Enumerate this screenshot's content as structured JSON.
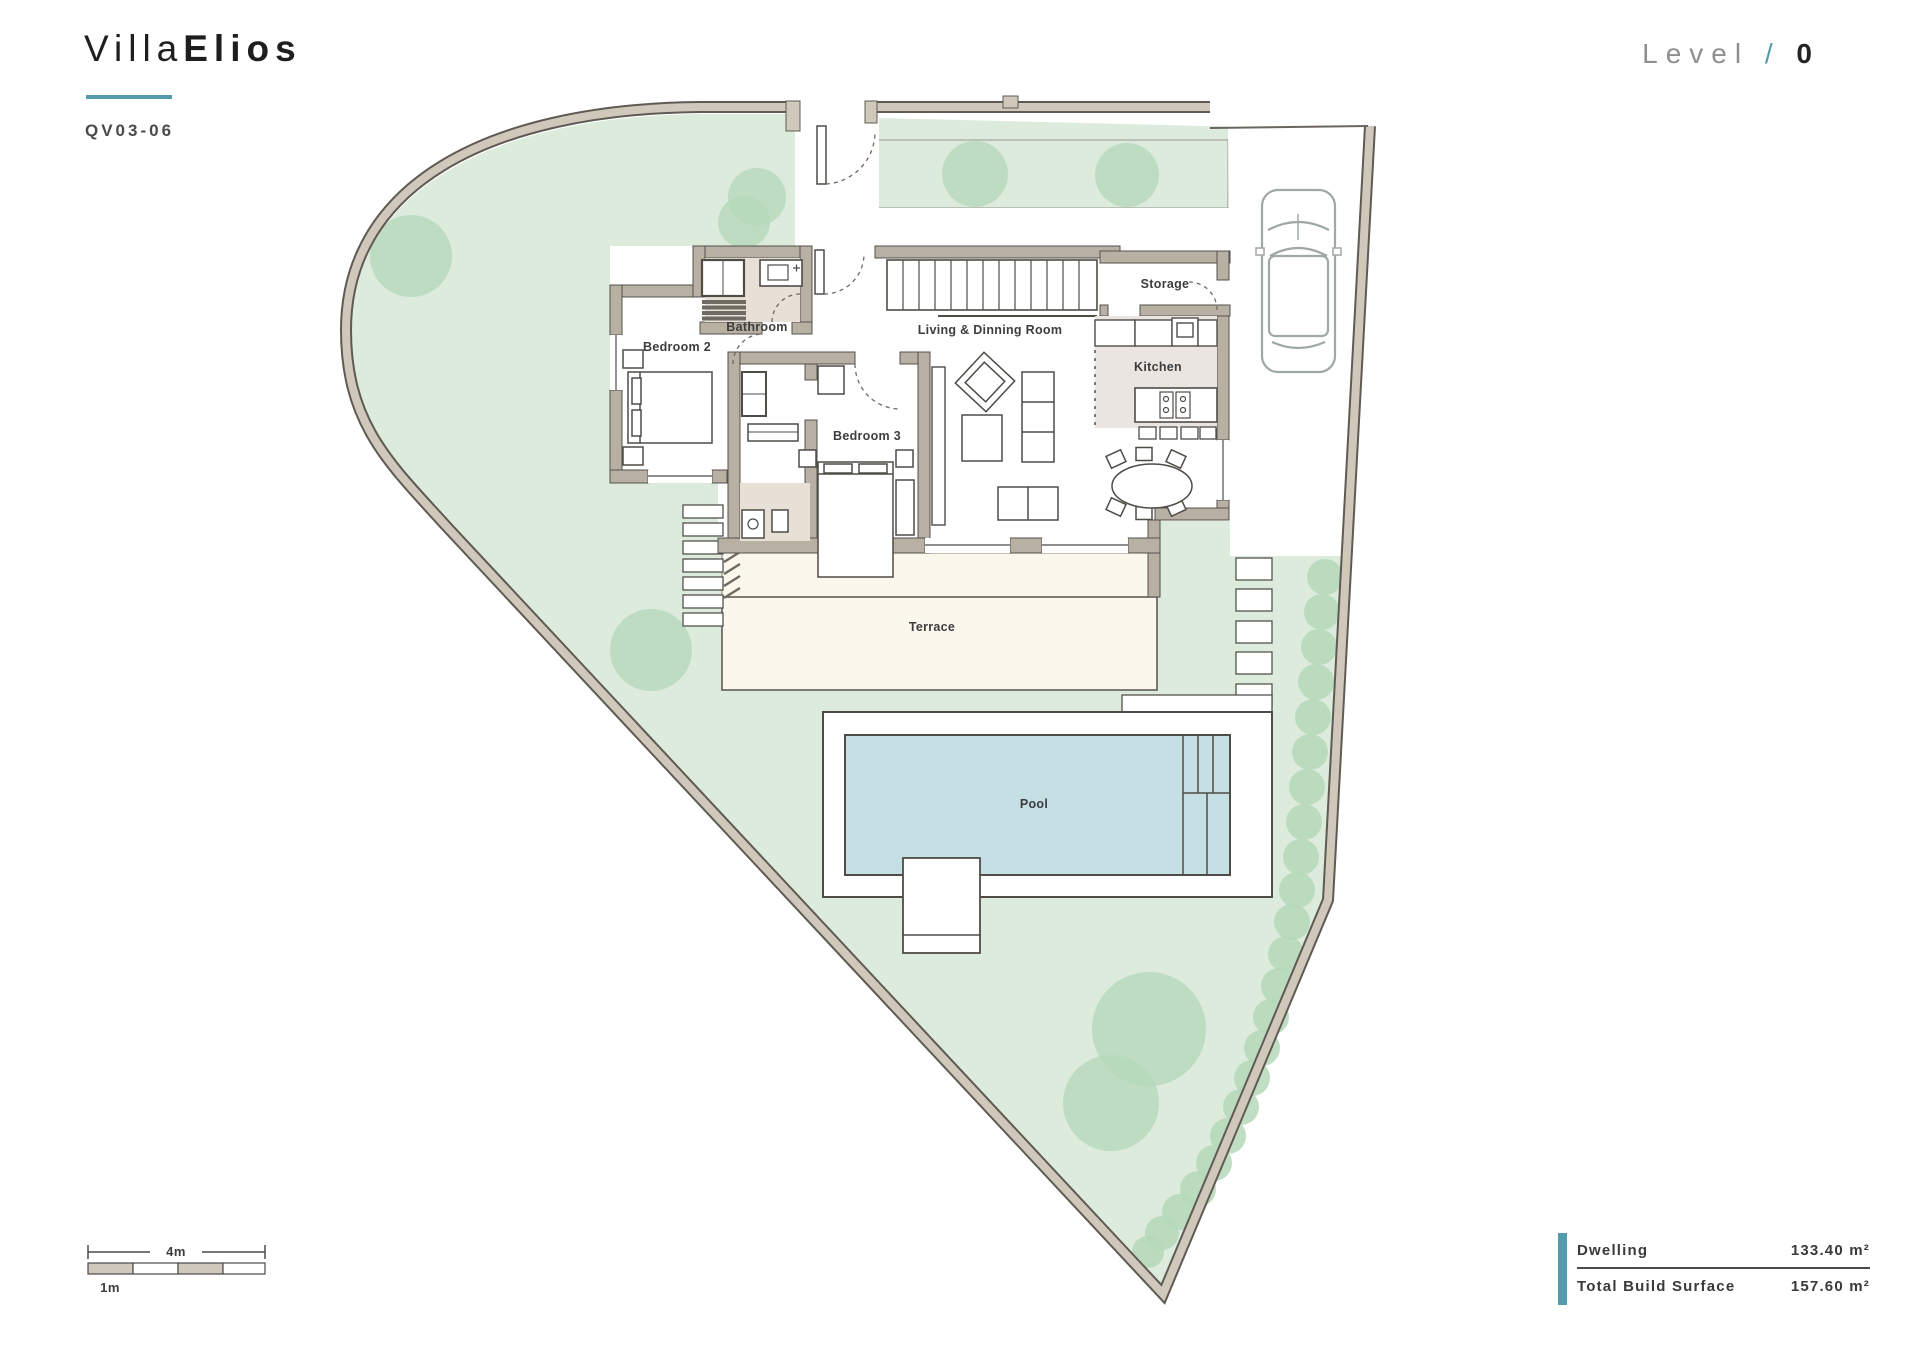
{
  "header": {
    "title_light": "Villa",
    "title_bold": "Elios",
    "unit_code": "QV03-06",
    "level_label": "Level",
    "level_sep": "/",
    "level_value": "0"
  },
  "plan": {
    "labels": {
      "bedroom2": "Bedroom 2",
      "bathroom": "Bathroom",
      "bedroom3": "Bedroom 3",
      "living": "Living & Dinning Room",
      "storage": "Storage",
      "kitchen": "Kitchen",
      "terrace": "Terrace",
      "pool": "Pool"
    }
  },
  "scale_bar": {
    "major": "4m",
    "minor": "1m"
  },
  "summary": {
    "rows": [
      {
        "label": "Dwelling",
        "value": "133.40 m²"
      },
      {
        "label": "Total Build Surface",
        "value": "157.60 m²"
      }
    ]
  },
  "colors": {
    "accent_teal": "#549BAB",
    "garden_green": "#DCEBDB",
    "tree_green": "#B5D8BA",
    "pool_blue": "#C4E0E5",
    "wall_tan": "#CFC8BB",
    "house_wall": "#B8B0A3",
    "terrace_cream": "#FBF7EC"
  }
}
